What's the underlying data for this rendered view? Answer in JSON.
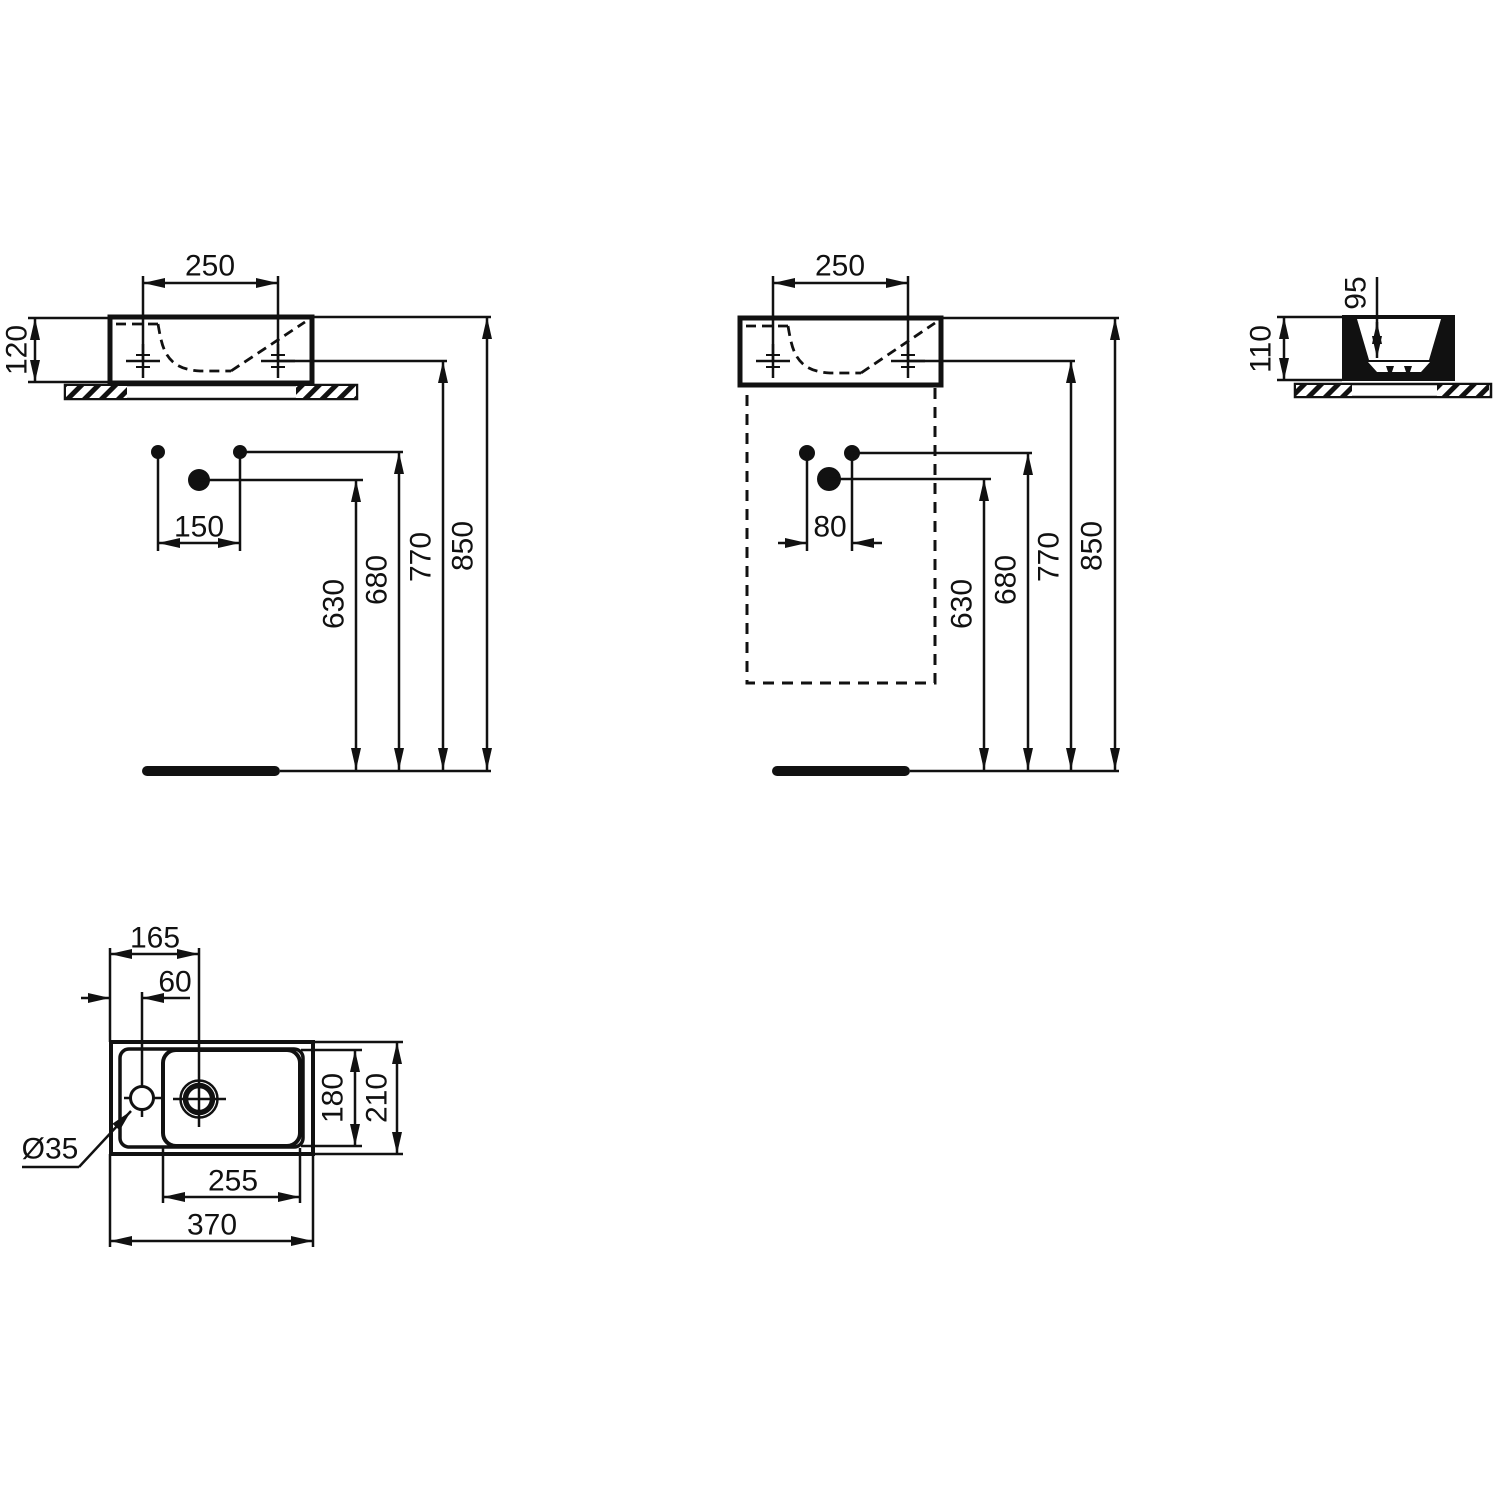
{
  "drawing": {
    "background": "#ffffff",
    "line_color": "#111111",
    "views": {
      "front_wall": {
        "dims": {
          "w250": "250",
          "h120": "120",
          "s150": "150",
          "v630": "630",
          "v680": "680",
          "v770": "770",
          "v850": "850"
        }
      },
      "front_furniture": {
        "dims": {
          "w250": "250",
          "s80": "80",
          "v630": "630",
          "v680": "680",
          "v770": "770",
          "v850": "850"
        }
      },
      "side": {
        "dims": {
          "d95": "95",
          "h110": "110"
        }
      },
      "plan": {
        "dims": {
          "l165": "165",
          "l60": "60",
          "d180": "180",
          "d210": "210",
          "w255": "255",
          "w370": "370",
          "dia": "Ø35"
        }
      }
    }
  }
}
